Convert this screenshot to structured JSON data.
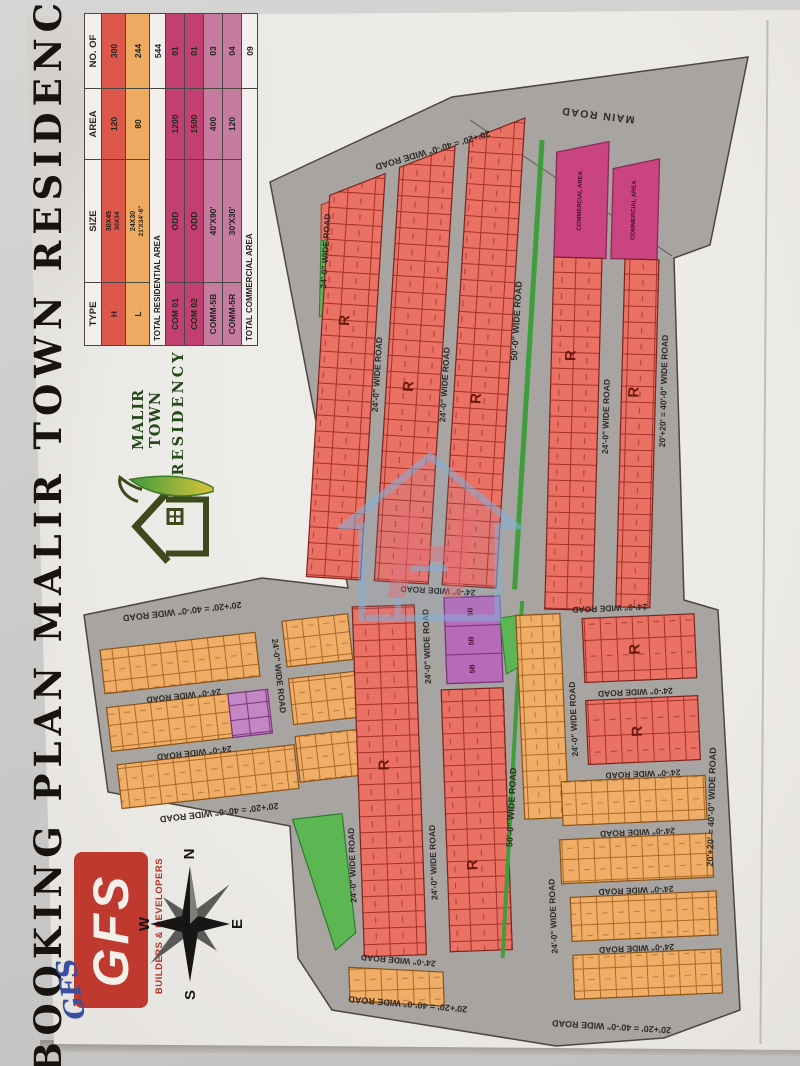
{
  "title": "BOOKING PLAN MALIR TOWN RESIDENCY",
  "legend": {
    "headers": [
      "TYPE",
      "SIZE",
      "AREA",
      "NO. OF"
    ],
    "rows": [
      {
        "type": "H",
        "size": "30X45",
        "size_alt": "30X34",
        "area": "120",
        "count": "300"
      },
      {
        "type": "L",
        "size": "24X30",
        "size_alt": "21'X34'-6\"",
        "area": "80",
        "count": "244"
      }
    ],
    "total_residential": {
      "label": "TOTAL RESIDENTIAL AREA",
      "value": "544"
    },
    "commercial_rows": [
      {
        "type": "COM 01",
        "size": "ODD",
        "area": "1200",
        "count": "01"
      },
      {
        "type": "COM 02",
        "size": "ODD",
        "area": "1500",
        "count": "01"
      },
      {
        "type": "COMM-5B",
        "size": "40'X90'",
        "area": "400",
        "count": "03"
      },
      {
        "type": "COMM-5R",
        "size": "30'X30'",
        "area": "120",
        "count": "04"
      }
    ],
    "total_commercial": {
      "label": "TOTAL COMMERCIAL AREA",
      "value": "09"
    }
  },
  "logo": {
    "line1": "MALIR TOWN",
    "line2": "RESIDENCY"
  },
  "developer": {
    "abbr": "GFS",
    "tagline": "BUILDERS & DEVELOPERS",
    "signature": "GFS"
  },
  "compass": {
    "n": "N",
    "s": "S",
    "e": "E",
    "w": "W"
  },
  "watermark": {
    "letter": "H"
  },
  "plan": {
    "labels": {
      "main_road": "MAIN ROAD",
      "road24": "24'-0\" WIDE ROAD",
      "road40": "20'+20' = 40'-0\" WIDE ROAD",
      "road50": "50'-0\" WIDE ROAD",
      "block_r": "R",
      "commercial": "COMMERCIAL AREA",
      "plot5b": "5B"
    }
  },
  "colors": {
    "residential_h": "#ec7165",
    "residential_l": "#f0ad67",
    "commercial": "#c94480",
    "commercial_5b": "#b66bb9",
    "park_green": "#5cb653",
    "road_gray": "#a7a4a2",
    "gfs_red": "#c0392e",
    "logo_green": "#234a18"
  }
}
